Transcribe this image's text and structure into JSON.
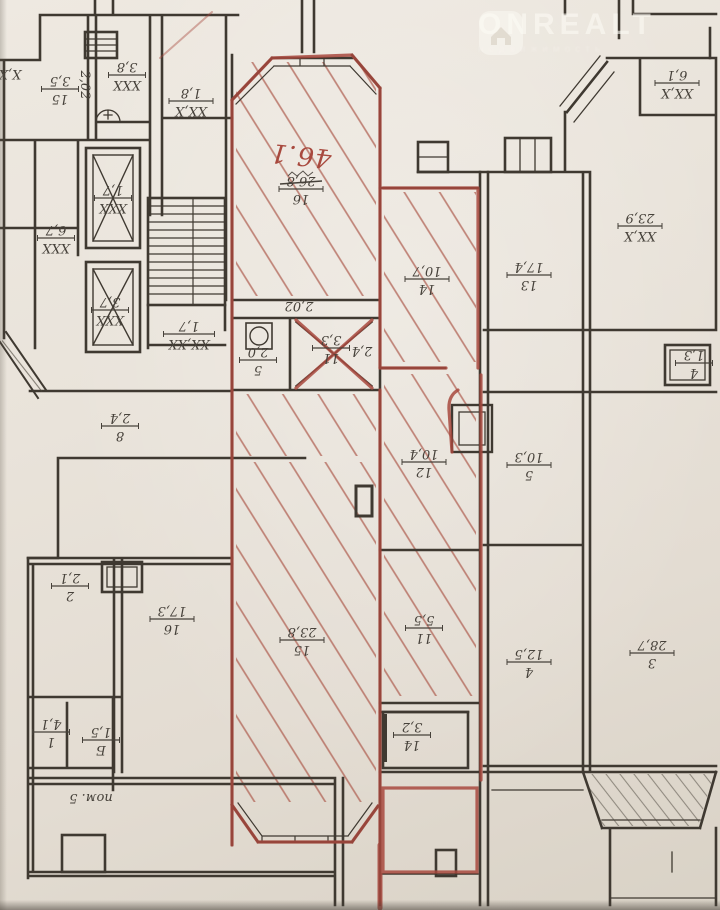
{
  "watermark": {
    "brand": "ONREALT",
    "subtext": "недвижимость"
  },
  "marker": {
    "handwritten_unit": "46.1",
    "color": "#a8493e",
    "hatch_color": "#ad5a4c"
  },
  "ink_color": "#3f3931",
  "labels": [
    {
      "top": "26,8",
      "bottom": "16",
      "x": 301,
      "y": 190,
      "struck": true
    },
    {
      "top": "2,0",
      "bottom": "5",
      "x": 258,
      "y": 361
    },
    {
      "top": "3,3",
      "bottom": "11",
      "x": 331,
      "y": 349
    },
    {
      "top": "2,4",
      "x": 362,
      "y": 352,
      "bar": false
    },
    {
      "top": "23,8",
      "bottom": "15",
      "x": 302,
      "y": 641
    },
    {
      "top": "10,7",
      "bottom": "14",
      "x": 427,
      "y": 280
    },
    {
      "top": "10,4",
      "bottom": "12",
      "x": 424,
      "y": 463
    },
    {
      "top": "5,5",
      "bottom": "11",
      "x": 424,
      "y": 629
    },
    {
      "top": "3,2",
      "bottom": "14",
      "x": 412,
      "y": 736
    },
    {
      "top": "3,5",
      "bottom": "15",
      "x": 60,
      "y": 90
    },
    {
      "top": "3,8",
      "bottom": "XXX",
      "x": 127,
      "y": 76
    },
    {
      "top": "1,8",
      "bottom": "XX,X",
      "x": 191,
      "y": 102
    },
    {
      "top": "X,X",
      "x": 10,
      "y": 75,
      "bar": false
    },
    {
      "top": "6,7",
      "bottom": "XXX",
      "x": 56,
      "y": 239
    },
    {
      "top": "1,7",
      "bottom": "XXX",
      "x": 113,
      "y": 199
    },
    {
      "top": "3,7",
      "bottom": "XXX",
      "x": 110,
      "y": 311
    },
    {
      "top": "1,7",
      "bottom": "XX,XX",
      "x": 189,
      "y": 335
    },
    {
      "top": "2,4",
      "bottom": "8",
      "x": 120,
      "y": 427
    },
    {
      "top": "2,1",
      "bottom": "2",
      "x": 70,
      "y": 587
    },
    {
      "top": "17,3",
      "bottom": "16",
      "x": 172,
      "y": 620
    },
    {
      "top": "4,1",
      "bottom": "1",
      "x": 51,
      "y": 733
    },
    {
      "top": "1,5",
      "bottom": "Б",
      "x": 101,
      "y": 741
    },
    {
      "top": "пом. 5",
      "x": 91,
      "y": 799,
      "bar": false
    },
    {
      "top": "17,4",
      "bottom": "13",
      "x": 529,
      "y": 276
    },
    {
      "top": "23,9",
      "bottom": "XX,X",
      "x": 640,
      "y": 227
    },
    {
      "top": "6,1",
      "bottom": "XX,X",
      "x": 677,
      "y": 84
    },
    {
      "top": "1,3",
      "bottom": "4",
      "x": 694,
      "y": 364
    },
    {
      "top": "10,3",
      "bottom": "5",
      "x": 529,
      "y": 466
    },
    {
      "top": "12,5",
      "bottom": "4",
      "x": 529,
      "y": 663
    },
    {
      "top": "28,7",
      "bottom": "3",
      "x": 652,
      "y": 654
    },
    {
      "top": "2,02",
      "x": 86,
      "y": 85,
      "bar": false,
      "rot": 90
    },
    {
      "top": "2,02",
      "x": 299,
      "y": 307,
      "bar": false
    },
    {
      "top": "46.1",
      "x": 301,
      "y": 152,
      "bar": false,
      "script": true,
      "rot": 186
    }
  ]
}
